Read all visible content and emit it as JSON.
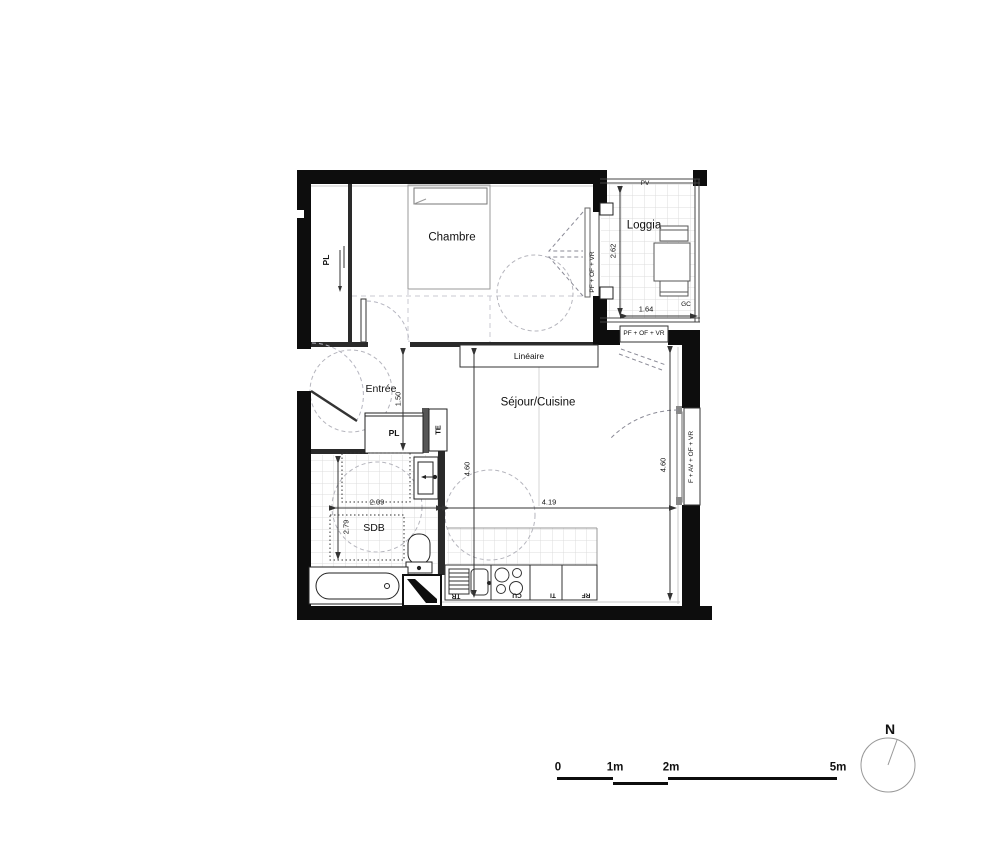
{
  "plan": {
    "rooms": {
      "chambre": "Chambre",
      "loggia": "Loggia",
      "entree": "Entrée",
      "sejour": "Séjour/Cuisine",
      "sdb": "SDB"
    },
    "closets": {
      "pl_chambre": "PL",
      "pl_entree": "PL",
      "te": "TE"
    },
    "annotations": {
      "lineaire": "Linéaire",
      "pv": "PV",
      "gc": "GC",
      "window_chambre_loggia": "PF + OF + VR",
      "window_loggia_sejour": "PF + OF + VR",
      "window_facade": "F + AV + OF + VR"
    },
    "kitchen": {
      "units": [
        "TR",
        "CU",
        "TI",
        "RF"
      ]
    },
    "dimensions": {
      "loggia_depth": "2.62",
      "loggia_width": "1.64",
      "entree_width": "1.50",
      "sejour_depth": "4.60",
      "sejour_width": "4.19",
      "sdb_width": "2.09",
      "sdb_depth": "2.79",
      "facade_window": "4.60"
    },
    "colors": {
      "wall": "#0d0d0d",
      "partition": "#2a2a2a",
      "grid": "#dcdcdc",
      "guide": "#b5b5c0"
    }
  },
  "scale_bar": {
    "labels": [
      "0",
      "1m",
      "2m",
      "5m"
    ]
  },
  "compass": {
    "north": "N"
  }
}
